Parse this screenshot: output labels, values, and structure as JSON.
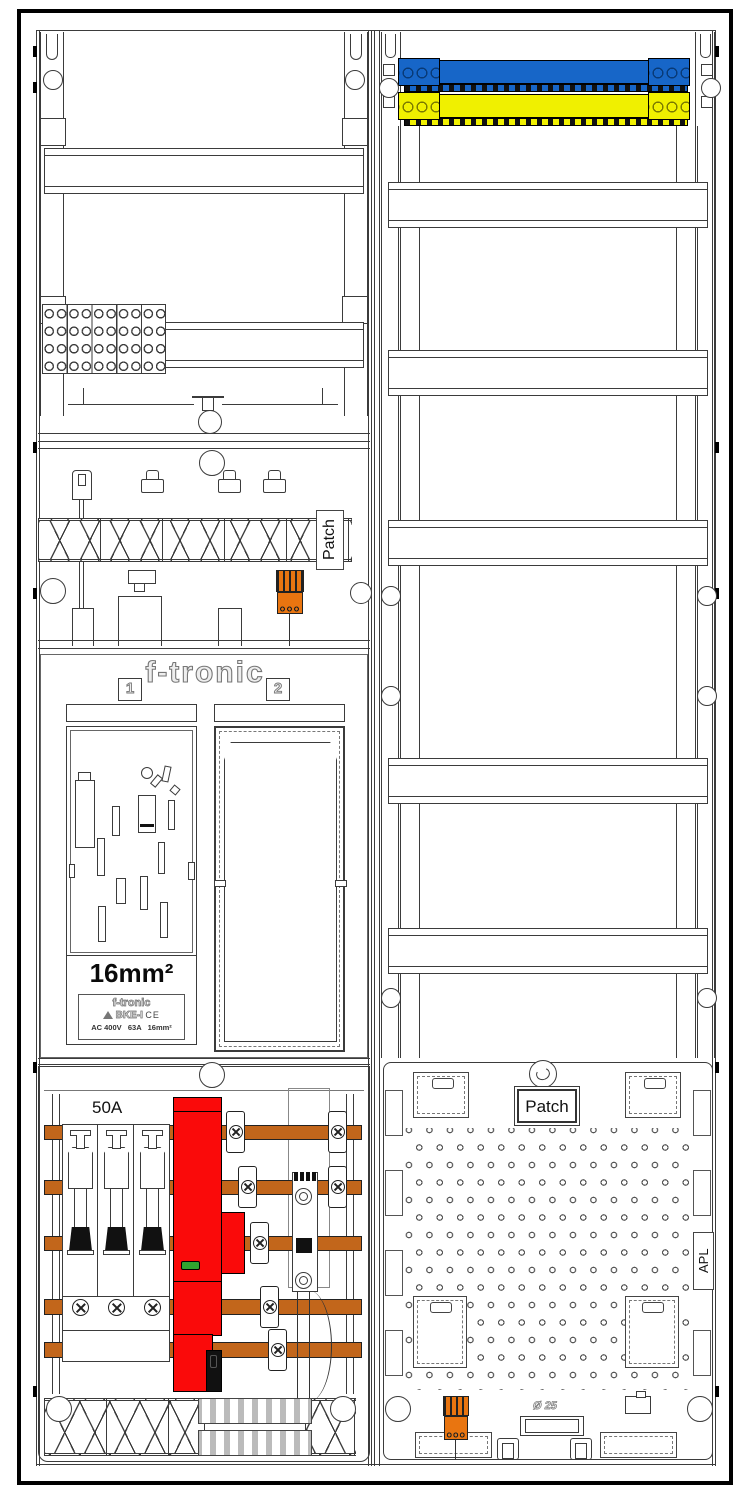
{
  "title": "Meter cabinet layout drawing",
  "labels": {
    "patch_left": "Patch",
    "patch_right": "Patch",
    "apl": "APL",
    "brand": "f-tronic",
    "field1": "1",
    "field2": "2",
    "cross_section": "16mm²",
    "sls_rating": "50A",
    "conduit": "Ø 25",
    "bke": {
      "brand": "f-tronic",
      "model": "BKE-I",
      "ce_mark": "CE",
      "specs": "AC 400V   63A   16mm²"
    }
  },
  "colors": {
    "line": "#3b3b3b",
    "blue": "#1766c8",
    "yellow": "#f0f000",
    "copper": "#c2661b",
    "red": "#fa0a0a",
    "orange": "#e97510",
    "green": "#2fa32f"
  }
}
